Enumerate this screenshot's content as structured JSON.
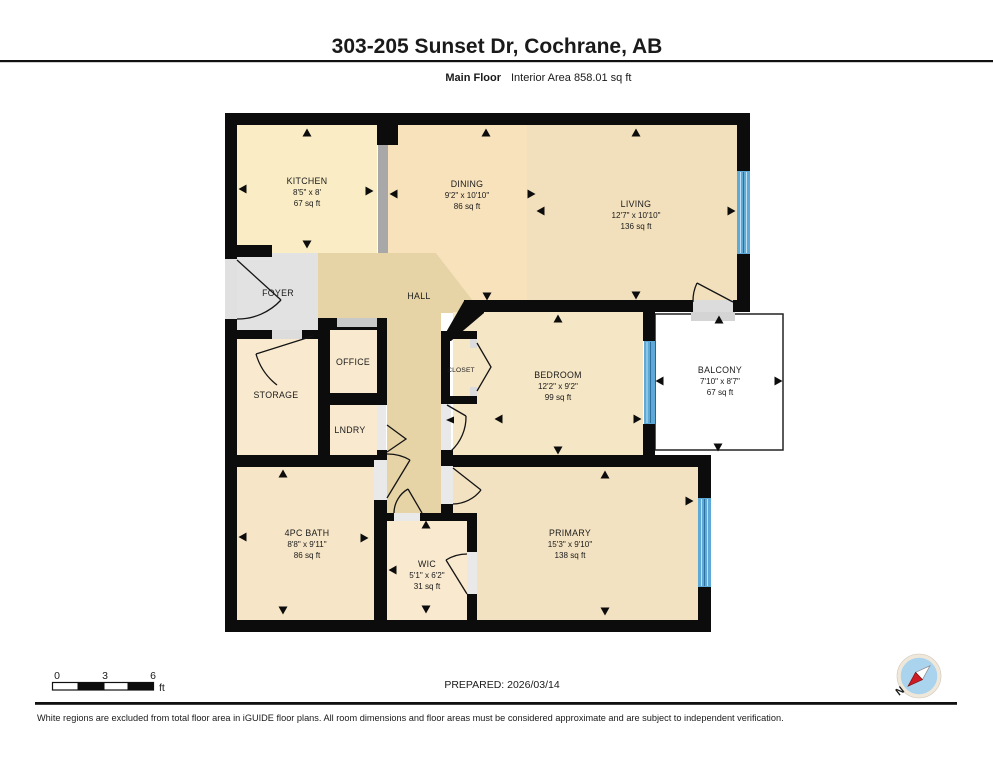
{
  "header": {
    "title": "303-205 Sunset Dr, Cochrane, AB",
    "floor_label": "Main Floor",
    "area_label": "Interior Area 858.01 sq ft"
  },
  "rooms": {
    "kitchen": {
      "name": "KITCHEN",
      "dims": "8'5\" x 8'",
      "area": "67 sq ft"
    },
    "dining": {
      "name": "DINING",
      "dims": "9'2\" x 10'10\"",
      "area": "86 sq ft"
    },
    "living": {
      "name": "LIVING",
      "dims": "12'7\" x 10'10\"",
      "area": "136 sq ft"
    },
    "foyer": {
      "name": "FOYER"
    },
    "hall": {
      "name": "HALL"
    },
    "office": {
      "name": "OFFICE"
    },
    "storage": {
      "name": "STORAGE"
    },
    "laundry": {
      "name": "LNDRY"
    },
    "closet": {
      "name": "CLOSET"
    },
    "bedroom": {
      "name": "BEDROOM",
      "dims": "12'2\" x 9'2\"",
      "area": "99 sq ft"
    },
    "balcony": {
      "name": "BALCONY",
      "dims": "7'10\" x 8'7\"",
      "area": "67 sq ft"
    },
    "bath": {
      "name": "4PC BATH",
      "dims": "8'8\" x 9'11\"",
      "area": "86 sq ft"
    },
    "wic": {
      "name": "WIC",
      "dims": "5'1\" x 6'2\"",
      "area": "31 sq ft"
    },
    "primary": {
      "name": "PRIMARY",
      "dims": "15'3\" x 9'10\"",
      "area": "138 sq ft"
    }
  },
  "scale_bar": {
    "tick_0": "0",
    "tick_3": "3",
    "tick_6": "6",
    "unit": "ft"
  },
  "footer": {
    "prepared": "PREPARED: 2026/03/14",
    "disclaimer": "White regions are excluded from total floor area in iGUIDE floor plans. All room dimensions and floor areas must be considered approximate and are subject to independent verification.",
    "compass_label": "N"
  },
  "colors": {
    "wall": "#0c0c0c",
    "kitchen_fill": "#faedc5",
    "dining_fill": "#f8e2bc",
    "living_fill": "#f2e0bc",
    "hall_fill": "#e6d3a6",
    "foyer_fill": "#e2e2e2",
    "small_room_fill": "#f9e9cf",
    "bedroom_fill": "#f5e6c5",
    "bath_fill": "#f6e6c7",
    "primary_fill": "#f3e2c1",
    "window_blue": "#5ea9d6",
    "balcony_fill": "#ffffff",
    "compass_blue": "#aad3ee",
    "compass_needle_red": "#cf1b24"
  }
}
